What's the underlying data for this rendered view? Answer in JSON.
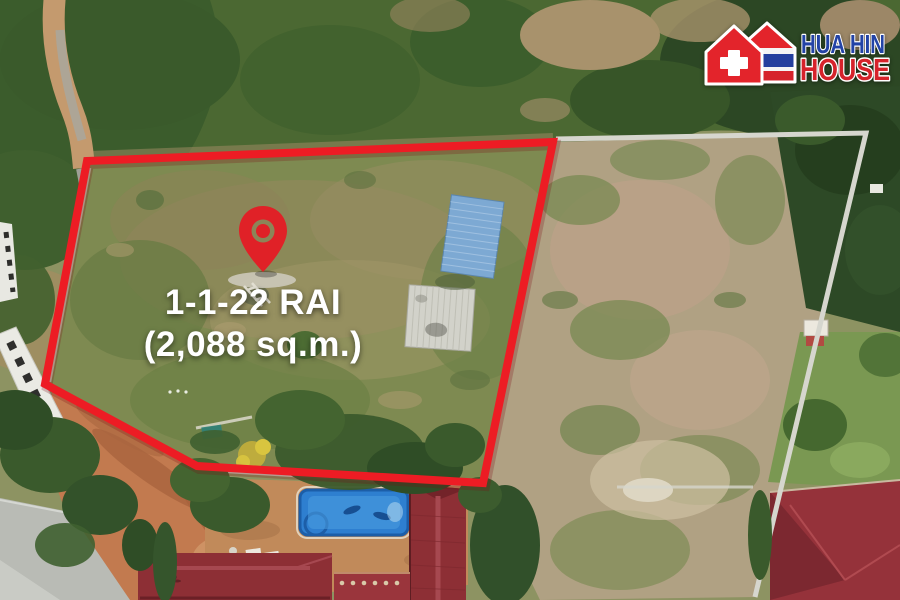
{
  "overlay": {
    "area_label": {
      "line1": "1-1-22 RAI",
      "line2": "(2,088 sq.m.)",
      "text_color": "#ffffff"
    },
    "boundary_color": "#ed1c24",
    "pin_color": "#e02127",
    "pin_icon": "red-map-pin"
  },
  "logo": {
    "icon": "twin-houses-swiss-cross-thai-flag",
    "title": "HUA HIN",
    "subtitle": "HOUSE",
    "title_color": "#2343a6",
    "subtitle_color": "#d6232b"
  }
}
